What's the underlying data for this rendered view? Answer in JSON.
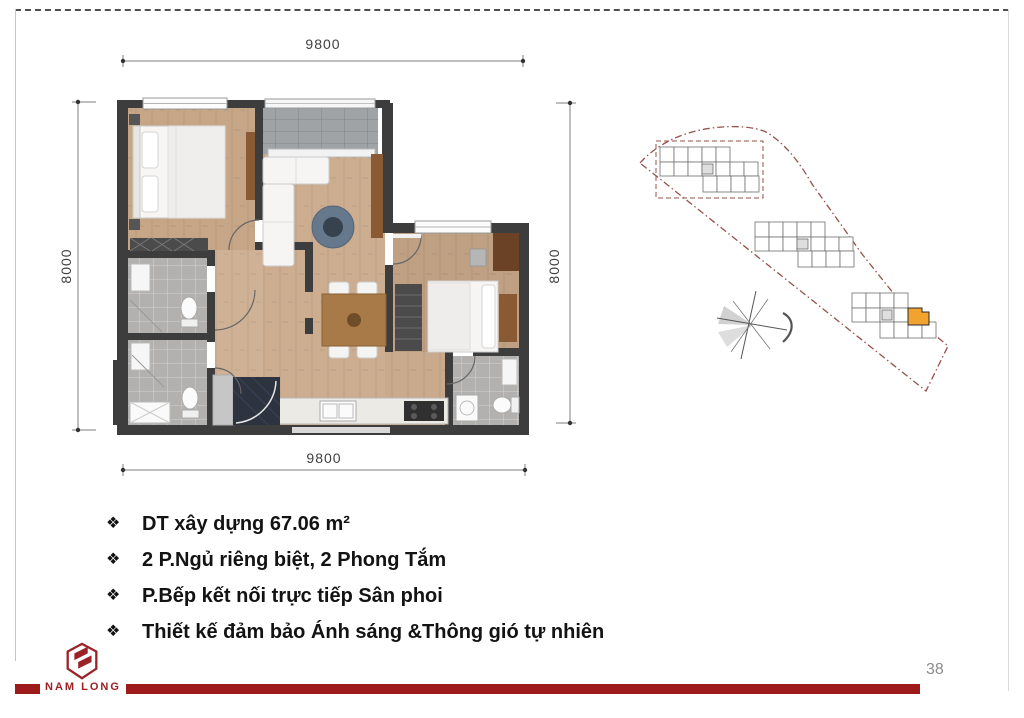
{
  "page": {
    "number": "38"
  },
  "brand": {
    "name": "NAM LONG",
    "color": "#9b1f23"
  },
  "floor_plan": {
    "dim_top": "9800",
    "dim_bottom": "9800",
    "dim_left": "8000",
    "dim_right": "8000"
  },
  "site_plan": {
    "highlight_color": "#f2a22e",
    "boundary_color": "#96524a",
    "highlighted_unit": "corner unit, lower-right block"
  },
  "bullets": {
    "marker": "❖",
    "items": [
      "DT xây dựng 67.06 m²",
      "2 P.Ngủ riêng biệt, 2 Phong Tắm",
      "P.Bếp kết nối trực tiếp Sân phoi",
      "Thiết kế đảm bảo Ánh sáng &Thông gió tự nhiên"
    ]
  },
  "icons": {
    "bullet": "four-diamond-bullet",
    "compass": "north-arrow-compass",
    "logo": "nam-long-cube-logo"
  }
}
